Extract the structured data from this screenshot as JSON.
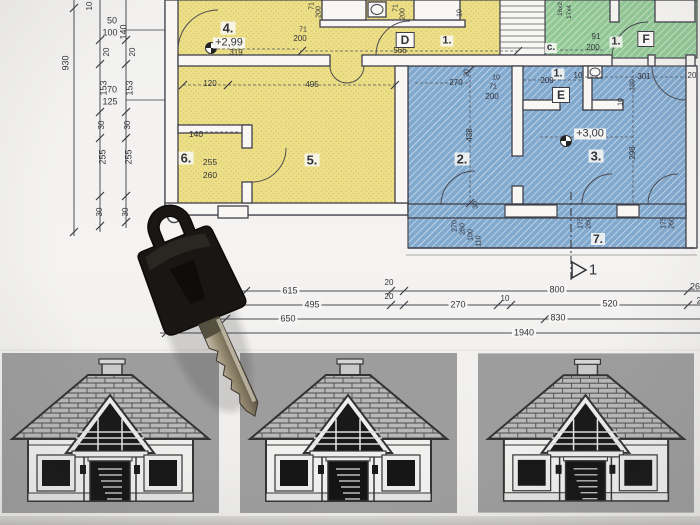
{
  "colors": {
    "paper": "#f2f1ef",
    "plan_yellow": "#ecdf87",
    "plan_blue": "#82a9ce",
    "plan_green": "#93c996",
    "plan_line": "#45454d",
    "house_panel_gray": "#9d9d9d",
    "house_roof_gray": "#b8b8b8",
    "key_black": "#191613",
    "key_blade_metal": "#9a9181"
  },
  "houses": {
    "count": 3
  },
  "plan": {
    "labels": [
      {
        "id": "dim-total-930",
        "t": "930",
        "x": 66,
        "y": 63,
        "r": 1
      },
      {
        "id": "dim-10-top",
        "t": "10",
        "x": 90,
        "y": 6,
        "r": 1,
        "s": 8
      },
      {
        "id": "dim-20-b",
        "t": "20",
        "x": 107,
        "y": 52,
        "r": 1,
        "s": 8
      },
      {
        "id": "dim-153-b",
        "t": "153",
        "x": 104,
        "y": 88,
        "r": 1
      },
      {
        "id": "dim-30-b1",
        "t": "30",
        "x": 102,
        "y": 125,
        "r": 1,
        "s": 8
      },
      {
        "id": "dim-255-b",
        "t": "255",
        "x": 103,
        "y": 157,
        "r": 1
      },
      {
        "id": "dim-30-b2",
        "t": "30",
        "x": 100,
        "y": 212,
        "r": 1,
        "s": 8
      },
      {
        "id": "dim-140-c",
        "t": "140",
        "x": 124,
        "y": 32,
        "r": 1
      },
      {
        "id": "dim-20-c",
        "t": "20",
        "x": 133,
        "y": 52,
        "r": 1,
        "s": 8
      },
      {
        "id": "dim-153-c",
        "t": "153",
        "x": 130,
        "y": 88,
        "r": 1
      },
      {
        "id": "dim-30-c1",
        "t": "30",
        "x": 128,
        "y": 125,
        "r": 1,
        "s": 8
      },
      {
        "id": "dim-255-c",
        "t": "255",
        "x": 129,
        "y": 157,
        "r": 1
      },
      {
        "id": "dim-30-c2",
        "t": "30",
        "x": 126,
        "y": 212,
        "r": 1,
        "s": 8
      },
      {
        "id": "wall-50",
        "t": "50",
        "x": 112,
        "y": 21
      },
      {
        "id": "wall-100",
        "t": "100",
        "x": 110,
        "y": 33
      },
      {
        "id": "wall-70",
        "t": "70",
        "x": 112,
        "y": 90
      },
      {
        "id": "wall-125",
        "t": "125",
        "x": 110,
        "y": 102
      },
      {
        "id": "room-4",
        "t": "4.",
        "x": 228,
        "y": 28,
        "s": 13,
        "b": 1
      },
      {
        "id": "level-yellow",
        "t": "+2,99",
        "x": 229,
        "y": 43,
        "s": 11,
        "bg": 1
      },
      {
        "id": "dim-319",
        "t": "319",
        "x": 236,
        "y": 53,
        "s": 8
      },
      {
        "id": "dim-120",
        "t": "120",
        "x": 210,
        "y": 84,
        "s": 8
      },
      {
        "id": "dim-495-top",
        "t": "495",
        "x": 312,
        "y": 85,
        "s": 8
      },
      {
        "id": "door-71-a",
        "t": "71",
        "x": 312,
        "y": 6,
        "r": 1,
        "s": 7
      },
      {
        "id": "door-200-a",
        "t": "200",
        "x": 319,
        "y": 12,
        "r": 1,
        "s": 7
      },
      {
        "id": "door-71-b",
        "t": "71",
        "x": 396,
        "y": 8,
        "r": 1,
        "s": 7
      },
      {
        "id": "door-200-b",
        "t": "200",
        "x": 403,
        "y": 14,
        "r": 1,
        "s": 7
      },
      {
        "id": "dim-10-r",
        "t": "10",
        "x": 460,
        "y": 13,
        "r": 1,
        "s": 7
      },
      {
        "id": "door-71-c",
        "t": "71",
        "x": 303,
        "y": 30,
        "s": 7
      },
      {
        "id": "door-200-c",
        "t": "200",
        "x": 300,
        "y": 39,
        "s": 8
      },
      {
        "id": "marker-D",
        "t": "D",
        "x": 405,
        "y": 40,
        "box": 1,
        "s": 12
      },
      {
        "id": "room-1-top",
        "t": "1.",
        "x": 447,
        "y": 41,
        "s": 11,
        "b": 1
      },
      {
        "id": "dim-566",
        "t": "566",
        "x": 400,
        "y": 51,
        "s": 8
      },
      {
        "id": "stair-note-1",
        "t": "16x2",
        "x": 561,
        "y": 9,
        "r": 1,
        "s": 6.5
      },
      {
        "id": "stair-note-2",
        "t": "17x4",
        "x": 570,
        "y": 12,
        "r": 1,
        "s": 6.5
      },
      {
        "id": "door-91",
        "t": "91",
        "x": 596,
        "y": 37,
        "s": 8
      },
      {
        "id": "door-200-d",
        "t": "200",
        "x": 593,
        "y": 48,
        "s": 8
      },
      {
        "id": "corridor-c",
        "t": "c.",
        "x": 551,
        "y": 48,
        "s": 10,
        "b": 1
      },
      {
        "id": "room-1-green",
        "t": "1.",
        "x": 616,
        "y": 42,
        "s": 11,
        "b": 1
      },
      {
        "id": "marker-F",
        "t": "F",
        "x": 646,
        "y": 39,
        "box": 1,
        "s": 12
      },
      {
        "id": "room-2",
        "t": "2.",
        "x": 462,
        "y": 159,
        "s": 13,
        "b": 1
      },
      {
        "id": "dim-438",
        "t": "438",
        "x": 470,
        "y": 135,
        "r": 1,
        "s": 8
      },
      {
        "id": "dim-270-top",
        "t": "270",
        "x": 456,
        "y": 83,
        "s": 8
      },
      {
        "id": "dim-20-rot",
        "t": "20",
        "x": 467,
        "y": 73,
        "r": 1,
        "s": 7
      },
      {
        "id": "dim-10-c",
        "t": "10",
        "x": 496,
        "y": 78,
        "s": 7
      },
      {
        "id": "door-71-d",
        "t": "71",
        "x": 493,
        "y": 87,
        "s": 7
      },
      {
        "id": "door-200-e",
        "t": "200",
        "x": 492,
        "y": 97,
        "s": 8
      },
      {
        "id": "dim-30-rot",
        "t": "30",
        "x": 476,
        "y": 205,
        "r": 1,
        "s": 7
      },
      {
        "id": "door-270-rot",
        "t": "270",
        "x": 455,
        "y": 226,
        "r": 1,
        "s": 7
      },
      {
        "id": "door-260-rot",
        "t": "260",
        "x": 463,
        "y": 229,
        "r": 1,
        "s": 7
      },
      {
        "id": "door-100-rot",
        "t": "100",
        "x": 471,
        "y": 235,
        "r": 1,
        "s": 7
      },
      {
        "id": "door-110-rot",
        "t": "110",
        "x": 479,
        "y": 241,
        "r": 1,
        "s": 7
      },
      {
        "id": "room-1-blue",
        "t": "1.",
        "x": 558,
        "y": 74,
        "s": 11,
        "b": 1
      },
      {
        "id": "dim-209",
        "t": "209",
        "x": 547,
        "y": 81,
        "s": 8
      },
      {
        "id": "dim-10-d",
        "t": "10",
        "x": 578,
        "y": 76,
        "s": 8
      },
      {
        "id": "dim-301",
        "t": "301",
        "x": 644,
        "y": 77,
        "s": 8
      },
      {
        "id": "dim-130",
        "t": "130",
        "x": 633,
        "y": 85,
        "r": 1,
        "s": 7
      },
      {
        "id": "dim-20-edge",
        "t": "20",
        "x": 692,
        "y": 76,
        "s": 8
      },
      {
        "id": "marker-E",
        "t": "E",
        "x": 561,
        "y": 95,
        "box": 1,
        "s": 12
      },
      {
        "id": "dim-10-rot",
        "t": "10",
        "x": 621,
        "y": 102,
        "r": 1,
        "s": 7
      },
      {
        "id": "level-blue",
        "t": "+3,00",
        "x": 590,
        "y": 134,
        "s": 11,
        "bg": 1
      },
      {
        "id": "room-3",
        "t": "3.",
        "x": 596,
        "y": 156,
        "s": 13,
        "b": 1
      },
      {
        "id": "dim-298",
        "t": "298",
        "x": 633,
        "y": 153,
        "r": 1,
        "s": 8
      },
      {
        "id": "room-7",
        "t": "7.",
        "x": 598,
        "y": 239,
        "s": 12,
        "b": 1
      },
      {
        "id": "win-175-a",
        "t": "175",
        "x": 581,
        "y": 223,
        "r": 1,
        "s": 7
      },
      {
        "id": "win-260-a",
        "t": "260",
        "x": 589,
        "y": 223,
        "r": 1,
        "s": 7
      },
      {
        "id": "win-175-b",
        "t": "175",
        "x": 664,
        "y": 223,
        "r": 1,
        "s": 7
      },
      {
        "id": "win-260-b",
        "t": "260",
        "x": 672,
        "y": 223,
        "r": 1,
        "s": 7
      },
      {
        "id": "room-6",
        "t": "6.",
        "x": 186,
        "y": 158,
        "s": 13,
        "b": 1
      },
      {
        "id": "dim-255-r6",
        "t": "255",
        "x": 210,
        "y": 162,
        "s": 8.5
      },
      {
        "id": "dim-260-r6",
        "t": "260",
        "x": 210,
        "y": 175,
        "s": 8.5
      },
      {
        "id": "dim-140-r6",
        "t": "140",
        "x": 196,
        "y": 134,
        "s": 8.5
      },
      {
        "id": "room-5",
        "t": "5.",
        "x": 312,
        "y": 160,
        "s": 13,
        "b": 1
      },
      {
        "id": "section-1",
        "t": "1",
        "x": 593,
        "y": 270,
        "s": 15
      },
      {
        "id": "dim-615",
        "t": "615",
        "x": 290,
        "y": 291,
        "bg": 1
      },
      {
        "id": "dim-20-l1",
        "t": "20",
        "x": 389,
        "y": 283,
        "s": 8
      },
      {
        "id": "dim-20-l2",
        "t": "20",
        "x": 389,
        "y": 297,
        "s": 8
      },
      {
        "id": "dim-495-bot",
        "t": "495",
        "x": 312,
        "y": 305,
        "bg": 1
      },
      {
        "id": "dim-270-bot",
        "t": "270",
        "x": 458,
        "y": 305,
        "bg": 1
      },
      {
        "id": "dim-10-bot",
        "t": "10",
        "x": 505,
        "y": 299,
        "s": 8
      },
      {
        "id": "dim-800",
        "t": "800",
        "x": 557,
        "y": 290,
        "bg": 1
      },
      {
        "id": "dim-520",
        "t": "520",
        "x": 610,
        "y": 304,
        "bg": 1
      },
      {
        "id": "dim-650",
        "t": "650",
        "x": 288,
        "y": 319,
        "bg": 1
      },
      {
        "id": "dim-830",
        "t": "830",
        "x": 558,
        "y": 318,
        "bg": 1
      },
      {
        "id": "dim-1940",
        "t": "1940",
        "x": 524,
        "y": 333,
        "bg": 1
      },
      {
        "id": "dim-26-clipped",
        "t": "26",
        "x": 695,
        "y": 287
      },
      {
        "id": "dim-2-clipped",
        "t": "2",
        "x": 699,
        "y": 301
      }
    ]
  }
}
